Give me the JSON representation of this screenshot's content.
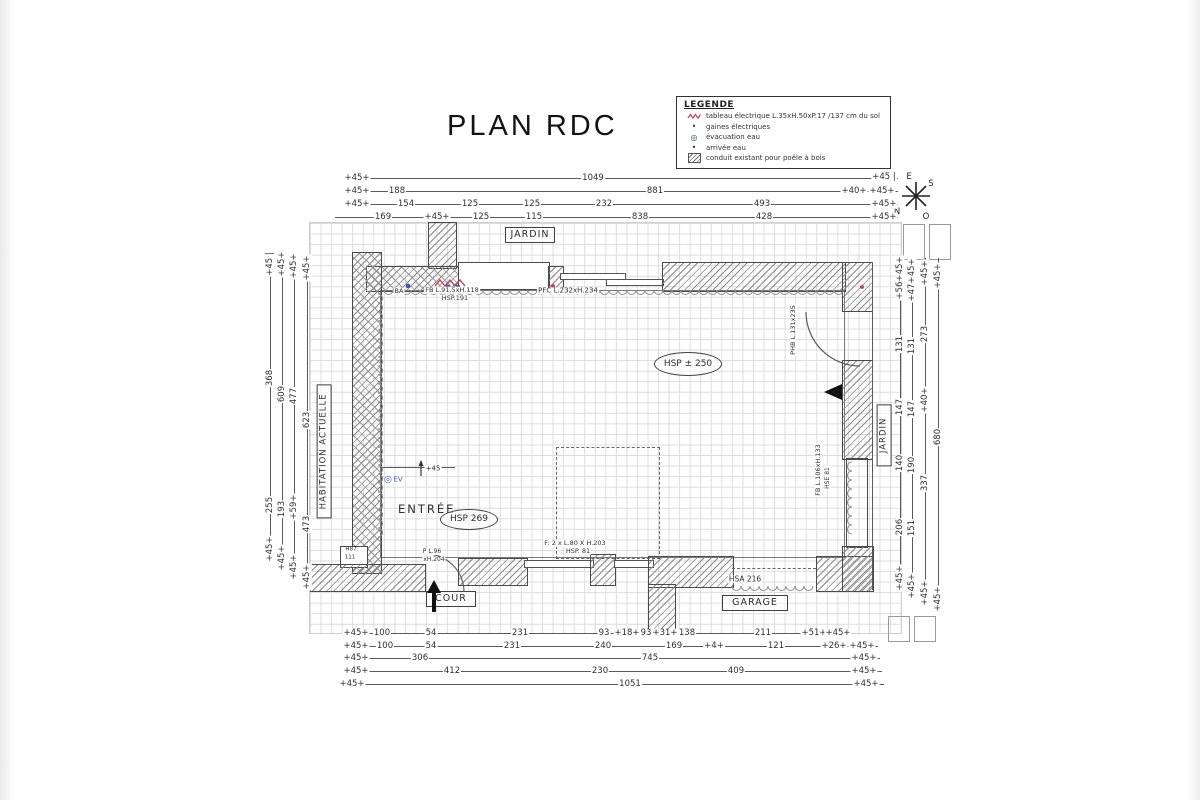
{
  "title": "PLAN RDC",
  "legend": {
    "title": "LEGENDE",
    "items": [
      {
        "symbol": "zigzag-red",
        "text": "tableau électrique L.35xH.50xP.17 /137 cm du sol"
      },
      {
        "symbol": "dot",
        "text": "gaines électriques"
      },
      {
        "symbol": "ring",
        "text": "évacuation eau"
      },
      {
        "symbol": "dot",
        "text": "arrivée eau"
      },
      {
        "symbol": "hatch-box",
        "text": "conduit existant pour poêle à bois"
      }
    ]
  },
  "compass": {
    "e": "E",
    "s": "S",
    "n": "N",
    "o": "O"
  },
  "rooms": {
    "jardin_top": "JARDIN",
    "jardin_right": "JARDIN",
    "habitation": "HABITATION ACTUELLE",
    "cour": "COUR",
    "garage": "GARAGE",
    "entree": "ENTRÉE"
  },
  "ceiling_heights": {
    "entree": "HSP 269",
    "sejour": "HSP ± 250"
  },
  "colors": {
    "ink": "#4a4a4a",
    "grid": "#dcdcdc",
    "red": "#c34a5e",
    "blue": "#3d55b8"
  },
  "plan": {
    "labels": [
      {
        "t": "+45+",
        "x": 357,
        "y": 178
      },
      {
        "t": "1049",
        "x": 593,
        "y": 178
      },
      {
        "t": "+45 |",
        "x": 884,
        "y": 177
      },
      {
        "t": "+45+",
        "x": 357,
        "y": 191
      },
      {
        "t": "188",
        "x": 397,
        "y": 191
      },
      {
        "t": "881",
        "x": 655,
        "y": 191
      },
      {
        "t": "+40+",
        "x": 854,
        "y": 191
      },
      {
        "t": "+45+",
        "x": 882,
        "y": 191
      },
      {
        "t": "+45+",
        "x": 357,
        "y": 204
      },
      {
        "t": "154",
        "x": 406,
        "y": 204
      },
      {
        "t": "125",
        "x": 470,
        "y": 204
      },
      {
        "t": "125",
        "x": 532,
        "y": 204
      },
      {
        "t": "232",
        "x": 604,
        "y": 204
      },
      {
        "t": "493",
        "x": 762,
        "y": 204
      },
      {
        "t": "+45+",
        "x": 884,
        "y": 204
      },
      {
        "t": "169",
        "x": 383,
        "y": 217
      },
      {
        "t": "+45+",
        "x": 437,
        "y": 217
      },
      {
        "t": "125",
        "x": 481,
        "y": 217
      },
      {
        "t": "115",
        "x": 534,
        "y": 217
      },
      {
        "t": "838",
        "x": 640,
        "y": 217
      },
      {
        "t": "428",
        "x": 764,
        "y": 217
      },
      {
        "t": "+45+",
        "x": 884,
        "y": 217
      },
      {
        "t": "+45 |",
        "x": 270,
        "y": 264,
        "r": 1
      },
      {
        "t": "368",
        "x": 270,
        "y": 378,
        "r": 1
      },
      {
        "t": "255",
        "x": 270,
        "y": 505,
        "r": 1
      },
      {
        "t": "+45+",
        "x": 270,
        "y": 549,
        "r": 1
      },
      {
        "t": "+45+",
        "x": 282,
        "y": 264,
        "r": 1
      },
      {
        "t": "609",
        "x": 282,
        "y": 394,
        "r": 1
      },
      {
        "t": "193",
        "x": 282,
        "y": 509,
        "r": 1
      },
      {
        "t": "+45+",
        "x": 282,
        "y": 558,
        "r": 1
      },
      {
        "t": "+45+",
        "x": 294,
        "y": 266,
        "r": 1
      },
      {
        "t": "477",
        "x": 294,
        "y": 396,
        "r": 1
      },
      {
        "t": "+59+",
        "x": 294,
        "y": 507,
        "r": 1
      },
      {
        "t": "+45+",
        "x": 294,
        "y": 567,
        "r": 1
      },
      {
        "t": "+45+",
        "x": 307,
        "y": 268,
        "r": 1
      },
      {
        "t": "623",
        "x": 307,
        "y": 420,
        "r": 1
      },
      {
        "t": "473",
        "x": 307,
        "y": 524,
        "r": 1
      },
      {
        "t": "+45+",
        "x": 307,
        "y": 577,
        "r": 1
      },
      {
        "t": "+45+",
        "x": 900,
        "y": 269,
        "r": 1
      },
      {
        "t": "+56+",
        "x": 900,
        "y": 287,
        "r": 1
      },
      {
        "t": "131",
        "x": 900,
        "y": 344,
        "r": 1
      },
      {
        "t": "147",
        "x": 900,
        "y": 407,
        "r": 1
      },
      {
        "t": "140",
        "x": 900,
        "y": 463,
        "r": 1
      },
      {
        "t": "206",
        "x": 900,
        "y": 527,
        "r": 1
      },
      {
        "t": "+45+",
        "x": 900,
        "y": 578,
        "r": 1
      },
      {
        "t": "+45+",
        "x": 912,
        "y": 271,
        "r": 1
      },
      {
        "t": "+47+",
        "x": 912,
        "y": 289,
        "r": 1
      },
      {
        "t": "131",
        "x": 912,
        "y": 346,
        "r": 1
      },
      {
        "t": "147",
        "x": 912,
        "y": 409,
        "r": 1
      },
      {
        "t": "190",
        "x": 912,
        "y": 465,
        "r": 1
      },
      {
        "t": "151",
        "x": 912,
        "y": 528,
        "r": 1
      },
      {
        "t": "+45+",
        "x": 912,
        "y": 586,
        "r": 1
      },
      {
        "t": "+45+",
        "x": 925,
        "y": 273,
        "r": 1
      },
      {
        "t": "273",
        "x": 925,
        "y": 334,
        "r": 1
      },
      {
        "t": "+40+",
        "x": 925,
        "y": 400,
        "r": 1
      },
      {
        "t": "337",
        "x": 925,
        "y": 483,
        "r": 1
      },
      {
        "t": "+45+",
        "x": 925,
        "y": 593,
        "r": 1
      },
      {
        "t": "+45+",
        "x": 938,
        "y": 276,
        "r": 1
      },
      {
        "t": "680",
        "x": 938,
        "y": 437,
        "r": 1
      },
      {
        "t": "+45+",
        "x": 938,
        "y": 599,
        "r": 1
      },
      {
        "t": "+45+",
        "x": 356,
        "y": 633
      },
      {
        "t": "100",
        "x": 382,
        "y": 633
      },
      {
        "t": "54",
        "x": 431,
        "y": 633
      },
      {
        "t": "231",
        "x": 520,
        "y": 633
      },
      {
        "t": "93",
        "x": 604,
        "y": 633
      },
      {
        "t": "+18+",
        "x": 627,
        "y": 633
      },
      {
        "t": "93",
        "x": 646,
        "y": 633
      },
      {
        "t": "+31+",
        "x": 665,
        "y": 633
      },
      {
        "t": "138",
        "x": 687,
        "y": 633
      },
      {
        "t": "211",
        "x": 763,
        "y": 633
      },
      {
        "t": "+51+",
        "x": 814,
        "y": 633
      },
      {
        "t": "+45+",
        "x": 838,
        "y": 633
      },
      {
        "t": "+45+",
        "x": 356,
        "y": 646
      },
      {
        "t": "100",
        "x": 385,
        "y": 646
      },
      {
        "t": "54",
        "x": 431,
        "y": 646
      },
      {
        "t": "231",
        "x": 512,
        "y": 646
      },
      {
        "t": "240",
        "x": 603,
        "y": 646
      },
      {
        "t": "169",
        "x": 674,
        "y": 646
      },
      {
        "t": "+4+",
        "x": 714,
        "y": 646
      },
      {
        "t": "121",
        "x": 776,
        "y": 646
      },
      {
        "t": "+26+",
        "x": 834,
        "y": 646
      },
      {
        "t": "+45+",
        "x": 862,
        "y": 646
      },
      {
        "t": "+45+",
        "x": 356,
        "y": 658
      },
      {
        "t": "306",
        "x": 420,
        "y": 658
      },
      {
        "t": "745",
        "x": 650,
        "y": 658
      },
      {
        "t": "+45+",
        "x": 864,
        "y": 658
      },
      {
        "t": "+45+",
        "x": 356,
        "y": 671
      },
      {
        "t": "412",
        "x": 452,
        "y": 671
      },
      {
        "t": "230",
        "x": 600,
        "y": 671
      },
      {
        "t": "409",
        "x": 736,
        "y": 671
      },
      {
        "t": "+45+",
        "x": 864,
        "y": 671
      },
      {
        "t": "+45+",
        "x": 352,
        "y": 684
      },
      {
        "t": "1051",
        "x": 630,
        "y": 684
      },
      {
        "t": "+45+",
        "x": 866,
        "y": 684
      },
      {
        "t": "BA",
        "x": 399,
        "y": 291,
        "s": 6.5,
        "n": "note-ba"
      },
      {
        "t": "FB L.91,5xH.118",
        "x": 452,
        "y": 290,
        "s": 6.5,
        "n": "window-fb1-label"
      },
      {
        "t": "HSP.191",
        "x": 455,
        "y": 298,
        "s": 6.5,
        "n": "window-fb1-height"
      },
      {
        "t": "PFC L.232xH.234",
        "x": 568,
        "y": 291,
        "s": 7,
        "n": "opening-pfc-label"
      },
      {
        "t": "PHB L.131x235",
        "x": 793,
        "y": 330,
        "s": 6.5,
        "r": 1,
        "n": "door-phb-label"
      },
      {
        "t": "FB L.106xH.133",
        "x": 818,
        "y": 470,
        "s": 6.5,
        "r": 1,
        "n": "window-fb2-label"
      },
      {
        "t": "HSE 81",
        "x": 828,
        "y": 478,
        "s": 6,
        "r": 1,
        "n": "window-fb2-height"
      },
      {
        "t": "EV",
        "x": 398,
        "y": 480,
        "s": 7,
        "c": "blue",
        "n": "water-evacuation-label"
      },
      {
        "t": "+45",
        "x": 433,
        "y": 469,
        "s": 7,
        "n": "level-step-label"
      },
      {
        "t": "P L.96",
        "x": 432,
        "y": 552,
        "s": 6,
        "n": "door-p-label"
      },
      {
        "t": "xH.204",
        "x": 434,
        "y": 560,
        "s": 6,
        "n": "door-p-label2"
      },
      {
        "t": "F: 2 x L.80 X H.203",
        "x": 575,
        "y": 543,
        "s": 6.5,
        "n": "window-f-label"
      },
      {
        "t": "HSP. 81",
        "x": 578,
        "y": 551,
        "s": 6.5,
        "n": "window-f-height"
      },
      {
        "t": "HSA 216",
        "x": 745,
        "y": 579,
        "s": 7.5,
        "n": "garage-opening-label"
      },
      {
        "t": "H87",
        "x": 351,
        "y": 550,
        "s": 5.5,
        "n": "niche-label"
      },
      {
        "t": "111",
        "x": 350,
        "y": 558,
        "s": 5.5,
        "n": "niche-label2"
      }
    ]
  }
}
